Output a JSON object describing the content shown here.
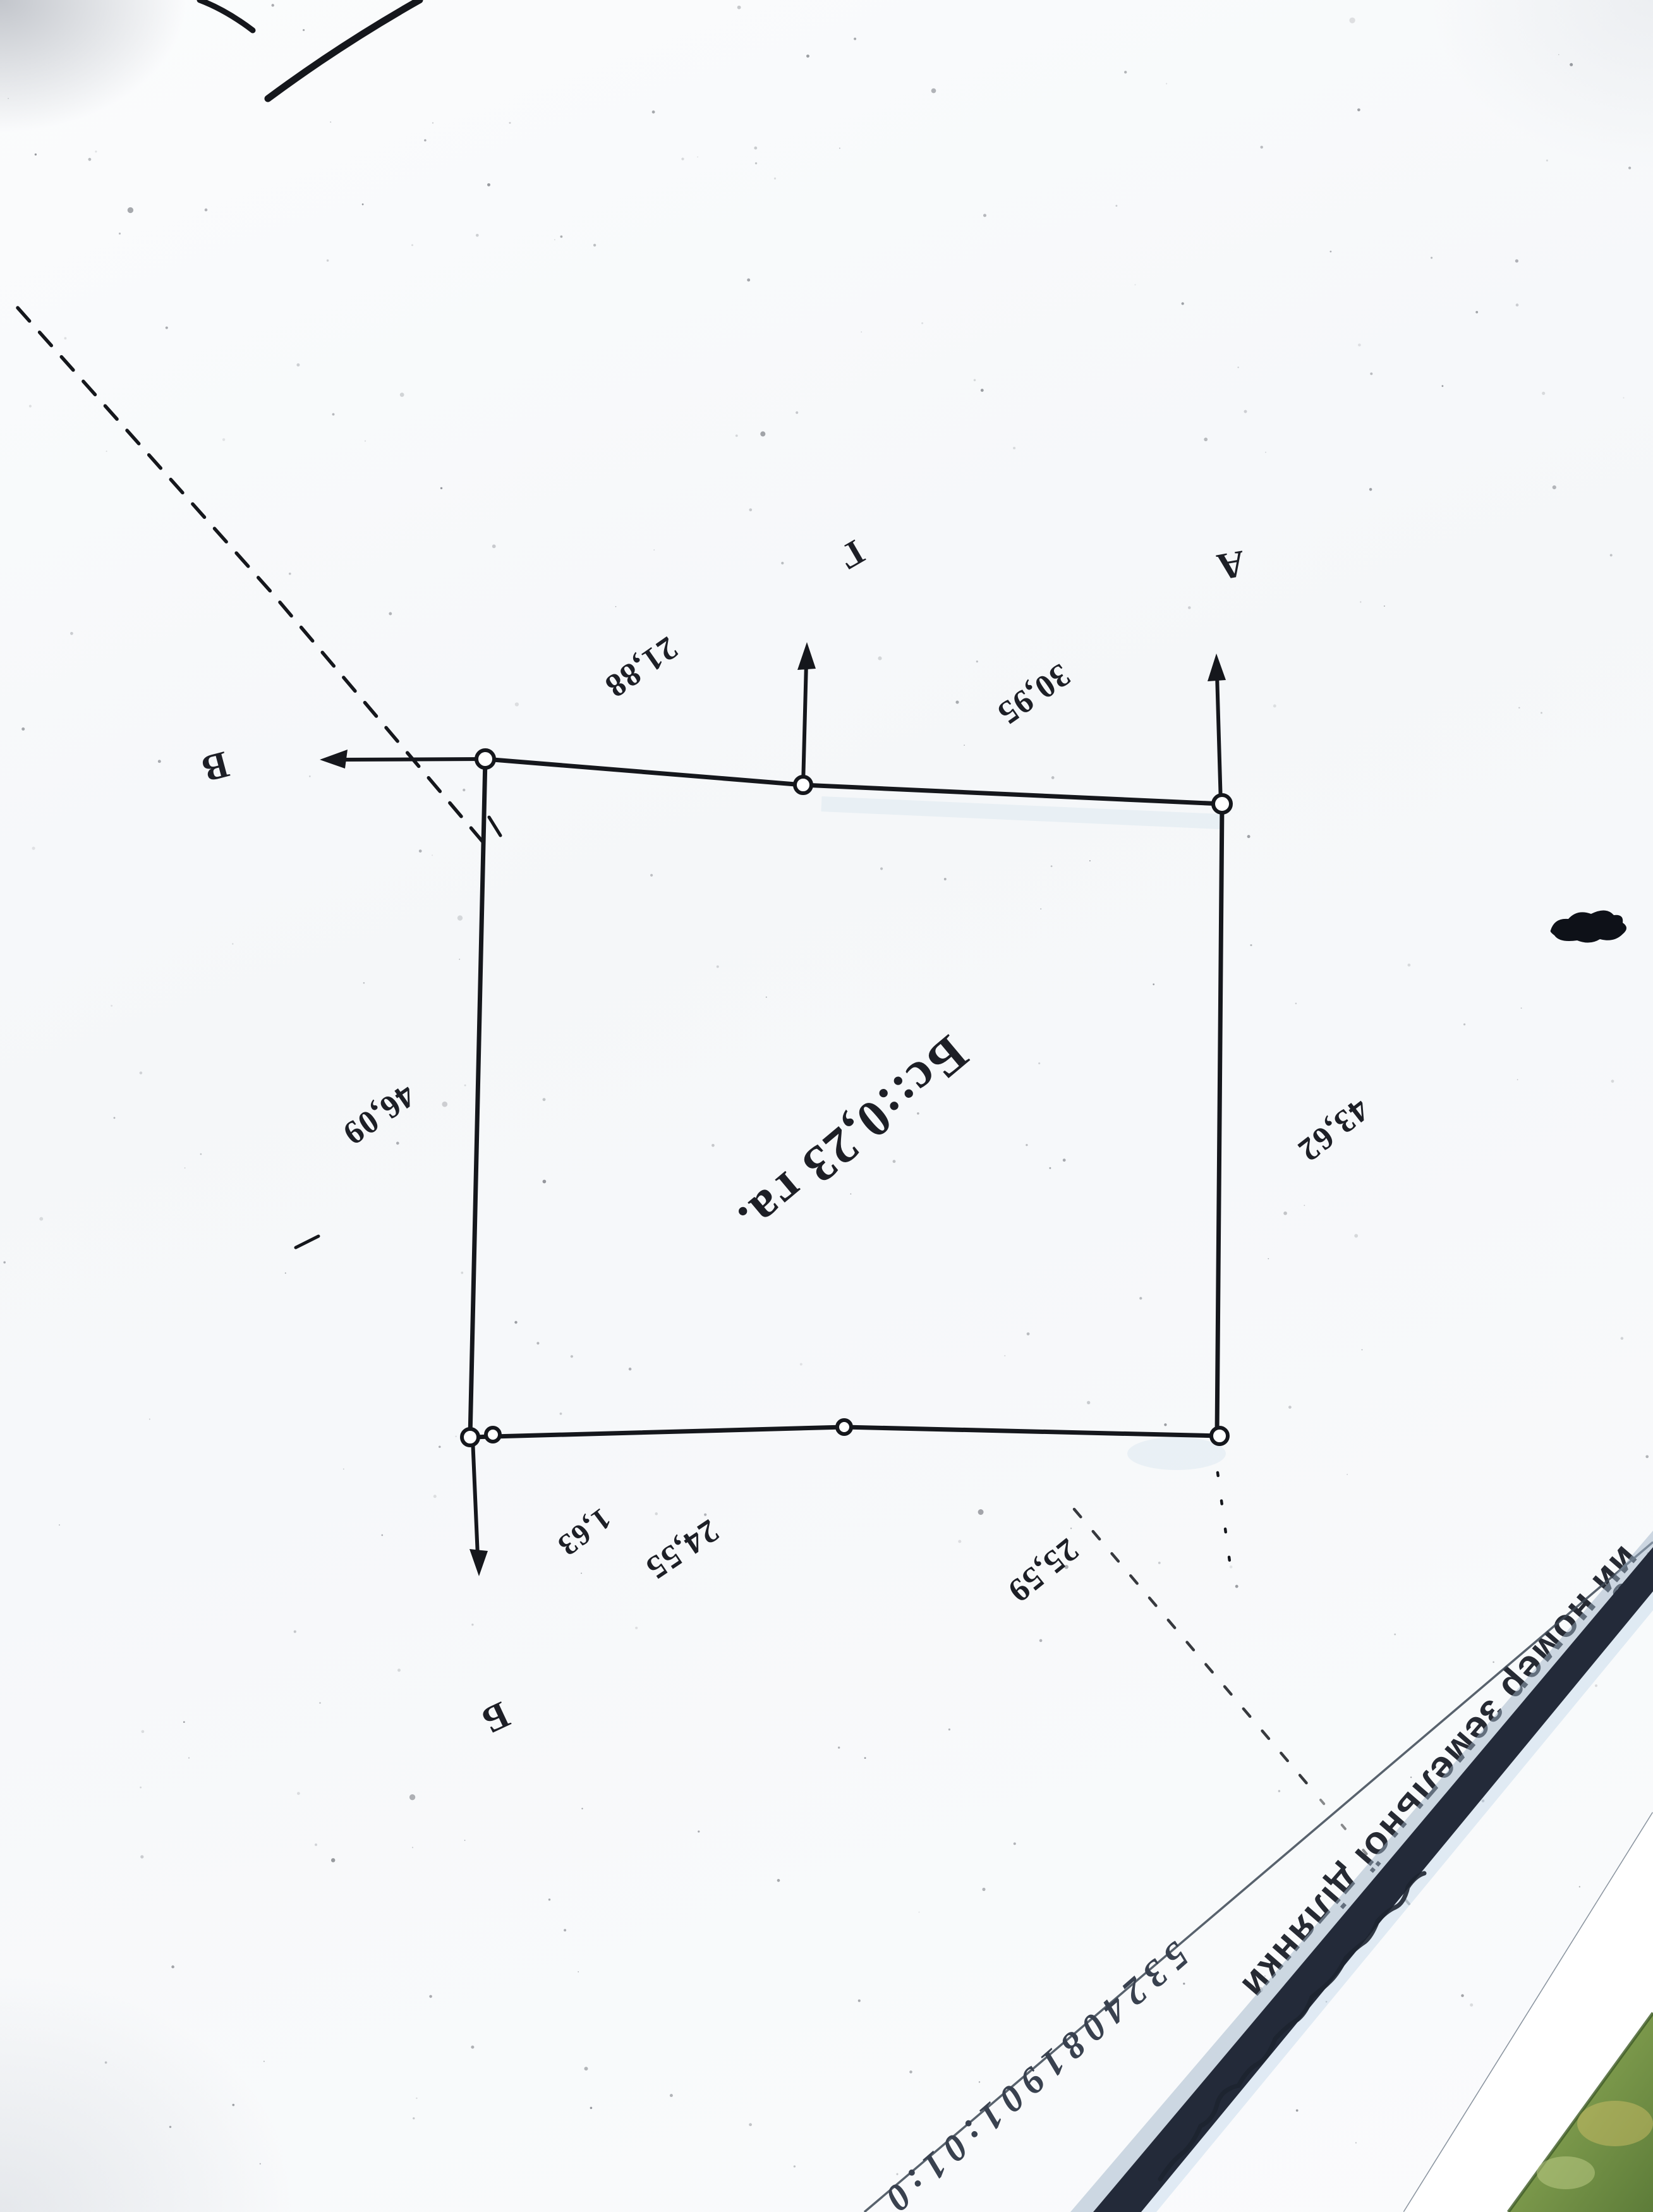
{
  "plan": {
    "area_label": "Бс::0,23 га.",
    "corner_labels": {
      "a": "А",
      "b": "Б",
      "v": "В",
      "g": "Г"
    },
    "dimensions": {
      "top_left_segment": "21,88",
      "top_right_segment": "30,95",
      "left_side": "46,09",
      "right_side": "43,62",
      "bottom_small": "1,63",
      "bottom_left_segment": "24,55",
      "bottom_right_segment": "25,59"
    }
  },
  "footer": {
    "caption_fragment": "ий номер земельної ділянки",
    "cadastral_number_fragment": "5324081901:01:0"
  }
}
